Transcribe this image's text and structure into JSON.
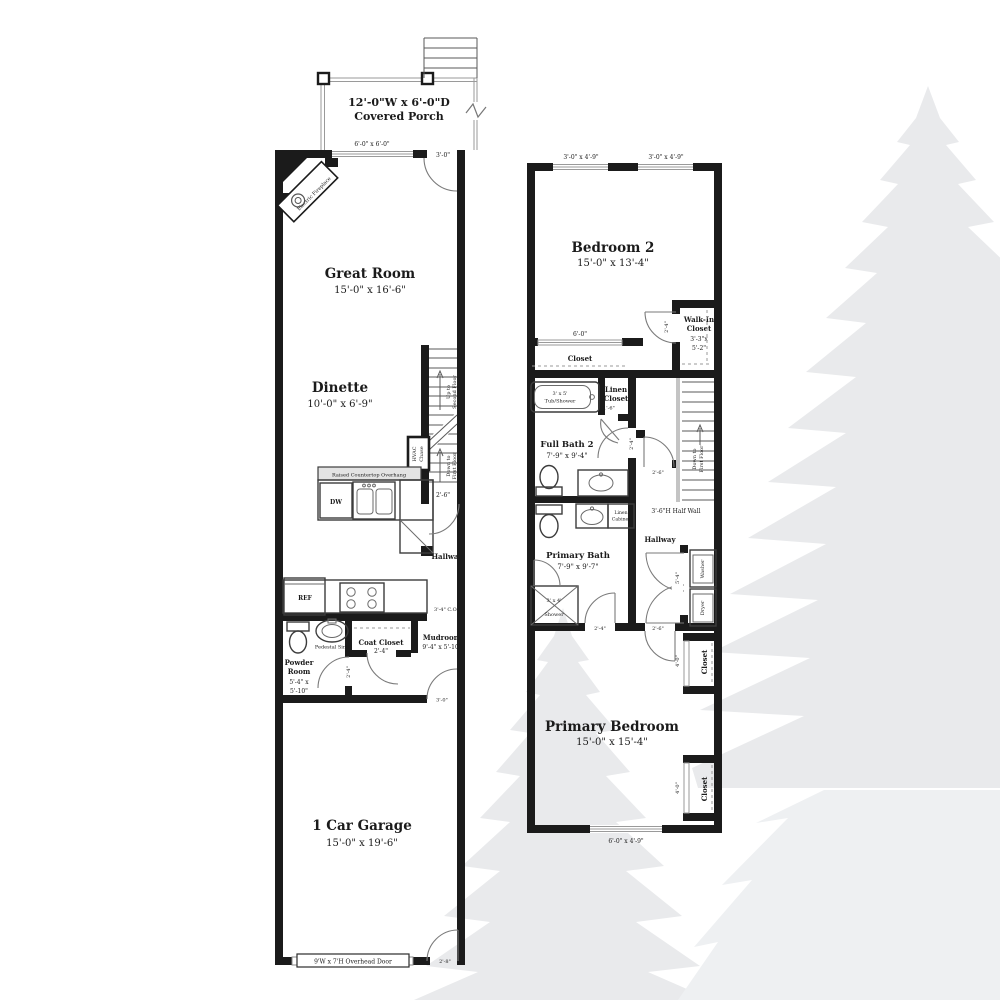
{
  "colors": {
    "walls": "#1b1b1b",
    "watermark": "#e9eaec",
    "watermark_light": "#eef0f2"
  },
  "ff": {
    "porch": {
      "dims": "12'-0\"W x 6'-0\"D",
      "name": "Covered Porch",
      "window": "6'-0\" x 6'-0\"",
      "door": "3'-0\""
    },
    "fireplace_label": "Electric Fireplace",
    "great_room": {
      "name": "Great Room",
      "dims": "15'-0\" x 16'-6\""
    },
    "dinette": {
      "name": "Dinette",
      "dims": "10'-0\" x 6'-9\""
    },
    "stairs": {
      "up1": "Up to",
      "up2": "Second Floor",
      "down1": "Down to",
      "down2": "First Floor"
    },
    "hvac": {
      "l1": "HVAC",
      "l2": "Chase"
    },
    "kitchen": {
      "countertop": "Raised Countertop Overhang",
      "dw": "DW",
      "ref": "REF",
      "co": "3'-4\" C.O."
    },
    "stair_door_dim": "2'-6\"",
    "hallway_label": "Hallway",
    "powder": {
      "l1": "Powder",
      "l2": "Room",
      "l3": "5'-4\" x",
      "l4": "5'-10\"",
      "sink": "Pedestal Sink",
      "door_dim": "2'-4\""
    },
    "coat": {
      "name": "Coat Closet",
      "dims": "2'-4\""
    },
    "mudroom": {
      "name": "Mudroom",
      "dims": "9'-4\" x 5'-10\"",
      "door_dim": "3'-0\""
    },
    "garage": {
      "name": "1 Car Garage",
      "dims": "15'-0\" x 19'-6\"",
      "overhead": "9'W x 7'H Overhead Door",
      "side_door_dim": "2'-8\""
    }
  },
  "sf": {
    "windows": {
      "top_left": "3'-0\" x 4'-9\"",
      "top_right": "3'-0\" x 4'-9\"",
      "bottom": "6'-0\" x 4'-9\""
    },
    "bedroom2": {
      "name": "Bedroom 2",
      "dims": "15'-0\" x 13'-4\"",
      "closet_name": "Closet",
      "closet_opening": "6'-0\""
    },
    "wic": {
      "l1": "Walk-In",
      "l2": "Closet",
      "l3": "3'-3\"x",
      "l4": "5'-2\"",
      "door_dim": "2'-4\""
    },
    "bath2": {
      "name": "Full Bath 2",
      "dims": "7'-9\" x 9'-4\"",
      "tub1": "3' x 5'",
      "tub2": "Tub/Shower",
      "door_dim": "2'-4\""
    },
    "linen": {
      "l1": "Linen",
      "l2": "Closet",
      "door_dim": "1'-6\""
    },
    "stairs": {
      "down1": "Down to",
      "down2": "First Floor",
      "half_wall": "3'-6\"H Half Wall"
    },
    "hall_door_dim": "2'-6\"",
    "hallway_label": "Hallway",
    "laundry": {
      "washer": "Washer",
      "dryer": "Dryer",
      "dim": "5'-4\""
    },
    "pbath": {
      "name": "Primary Bath",
      "dims": "7'-9\" x 9'-7\"",
      "shower1": "3' x 4'",
      "shower2": "Shower",
      "door_dim": "2'-4\"",
      "cab1": "Linen",
      "cab2": "Cabinet"
    },
    "bedroom_door_dim": "2'-6\"",
    "closet_upper": {
      "name": "Closet",
      "dim": "4'-0\""
    },
    "closet_lower": {
      "name": "Closet",
      "dim": "4'-0\""
    },
    "primary": {
      "name": "Primary Bedroom",
      "dims": "15'-0\" x 15'-4\""
    }
  }
}
